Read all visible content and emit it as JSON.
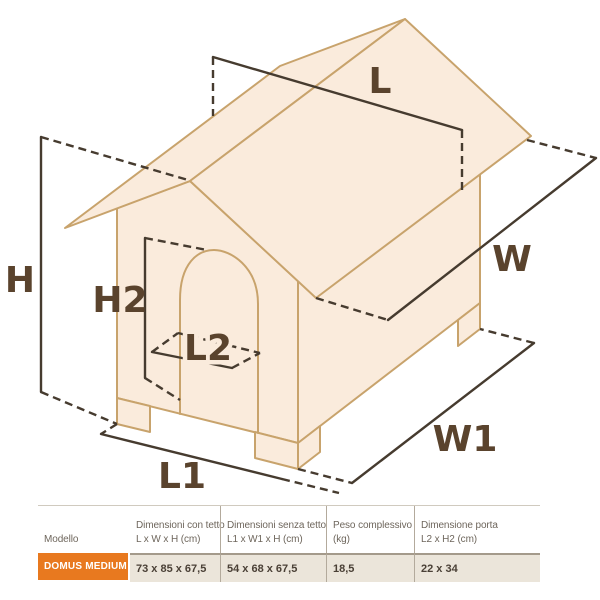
{
  "diagram": {
    "dimension_labels": {
      "roof_length": "L",
      "roof_depth": "W",
      "total_height": "H",
      "door_height": "H2",
      "door_width": "L2",
      "base_length": "L1",
      "base_depth": "W1"
    },
    "colors": {
      "house_fill": "#faebdc",
      "house_outline": "#c8a36c",
      "dimension_line": "#463b2f",
      "label_text": "#5a432d"
    }
  },
  "table": {
    "columns": [
      {
        "label_line1": "Modello",
        "label_line2": ""
      },
      {
        "label_line1": "Dimensioni con tetto",
        "label_line2": "L x W x H (cm)"
      },
      {
        "label_line1": "Dimensioni senza tetto",
        "label_line2": "L1 x W1 x H (cm)"
      },
      {
        "label_line1": "Peso complessivo",
        "label_line2": "(kg)"
      },
      {
        "label_line1": "Dimensione porta",
        "label_line2": "L2 x H2 (cm)"
      }
    ],
    "row": {
      "model": "DOMUS MEDIUM",
      "dim_with_roof": "73 x 85 x 67,5",
      "dim_without_roof": "54 x 68 x 67,5",
      "weight": "18,5",
      "door_size": "22 x 34"
    },
    "colors": {
      "model_bg": "#e8791f",
      "row_bg": "#ebe5da",
      "header_text": "#6e665c",
      "value_text": "#4a4036"
    }
  }
}
